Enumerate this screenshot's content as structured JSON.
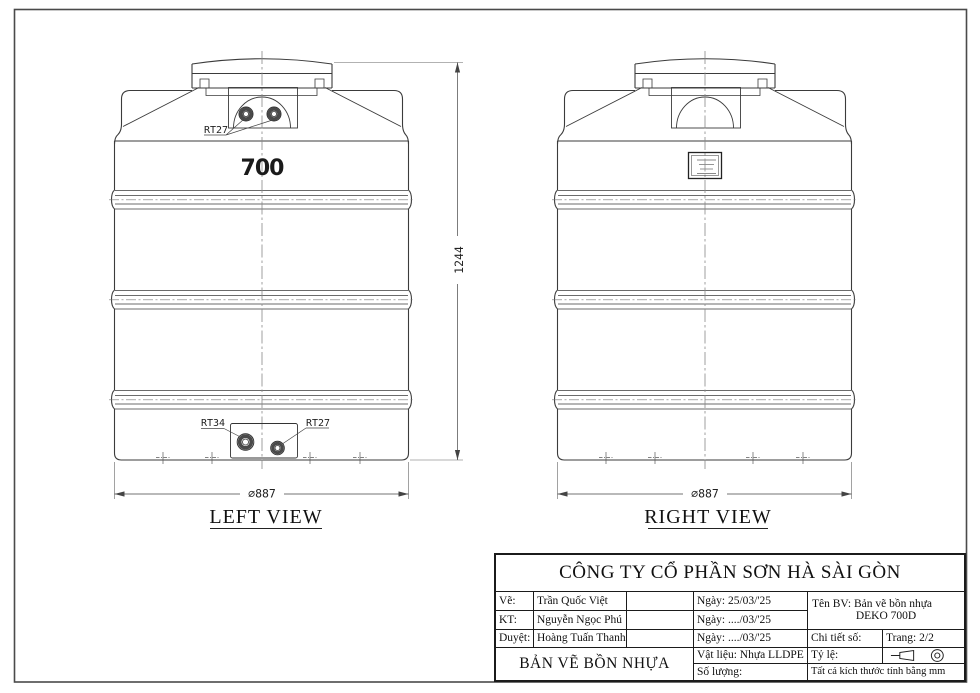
{
  "views": {
    "left": {
      "caption": "LEFT VIEW",
      "capacity": "700",
      "top_fitting": "RT27",
      "bottom_fitting_left": "RT34",
      "bottom_fitting_right": "RT27",
      "diameter": "∅887"
    },
    "right": {
      "caption": "RIGHT VIEW",
      "diameter": "∅887"
    },
    "height_dim": "1244"
  },
  "title_block": {
    "company": "CÔNG TY CỔ PHẦN SƠN HÀ SÀI GÒN",
    "rows": [
      {
        "role": "Vẽ:",
        "name": "Trần Quốc Việt",
        "date": "Ngày: 25/03/'25"
      },
      {
        "role": "KT:",
        "name": "Nguyễn Ngọc Phú",
        "date": "Ngày: ..../03/'25"
      },
      {
        "role": "Duyệt:",
        "name": "Hoàng Tuấn Thanh",
        "date": "Ngày: ..../03/'25"
      }
    ],
    "name_label": "Tên BV: Bản vẽ bồn nhựa",
    "model": "DEKO 700D",
    "detail_label": "Chi tiết số:",
    "page_label": "Trang: 2/2",
    "material_label": "Vật liệu: Nhựa LLDPE",
    "scale_label": "Tỷ lệ:",
    "quantity_label": "Số lượng:",
    "units_note": "Tất cả kích thước tính bằng mm",
    "sheet_title": "BẢN VẼ BỒN NHỰA"
  }
}
